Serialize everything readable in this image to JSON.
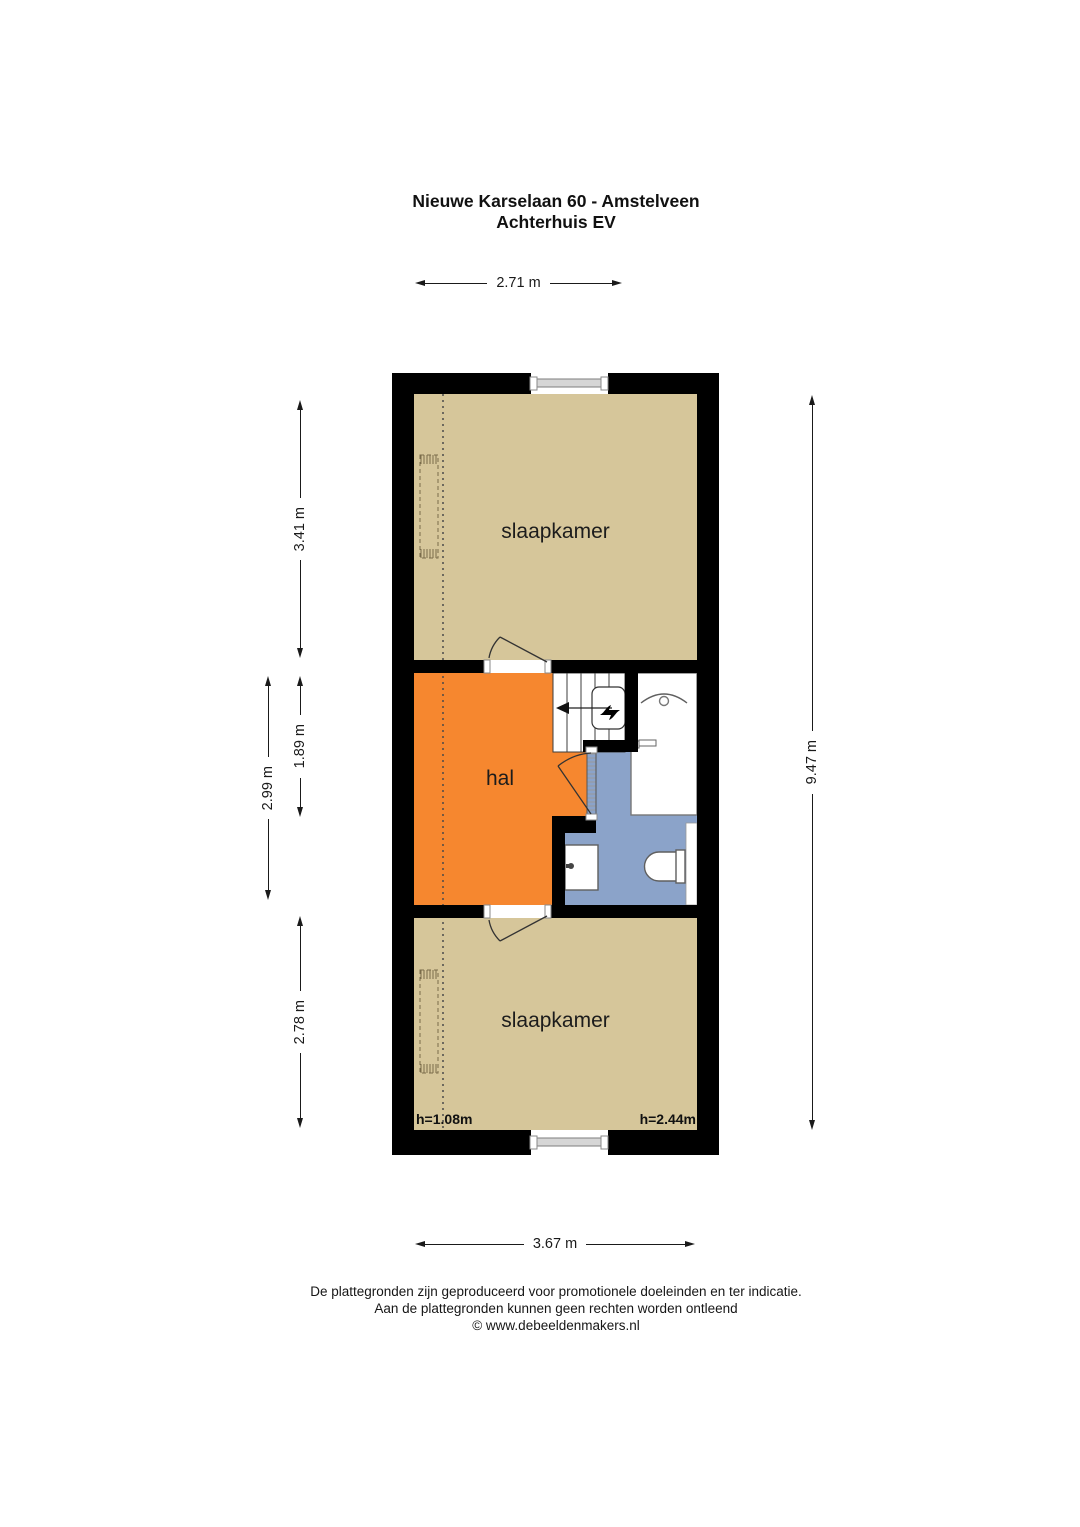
{
  "title": {
    "line1": "Nieuwe Karselaan 60 - Amstelveen",
    "line2": "Achterhuis EV"
  },
  "dimensions": {
    "top_width": "2.71 m",
    "bottom_width": "3.67 m",
    "right_height": "9.47 m",
    "bedroom_top_depth": "3.41 m",
    "middle_depth_outer": "2.99 m",
    "hall_depth_inner": "1.89 m",
    "bedroom_bottom_depth": "2.78 m"
  },
  "rooms": {
    "bedroom_top_label": "slaapkamer",
    "hall_label": "hal",
    "bedroom_bottom_label": "slaapkamer"
  },
  "ceiling_heights": {
    "left": "h=1.08m",
    "right": "h=2.44m"
  },
  "footer": {
    "line1": "De plattegronden zijn geproduceerd voor promotionele doeleinden en ter indicatie.",
    "line2": "Aan de plattegronden kunnen geen rechten worden ontleend",
    "line3": "© www.debeeldenmakers.nl"
  },
  "colors": {
    "wall": "#000000",
    "floor-bedroom": "#d6c69a",
    "floor-hall": "#f6872f",
    "floor-bathroom": "#8ba3c9",
    "fixture-stroke": "#5f5f5f",
    "window-fill": "#d6d6d6",
    "dim-line": "#1a1a1a"
  }
}
